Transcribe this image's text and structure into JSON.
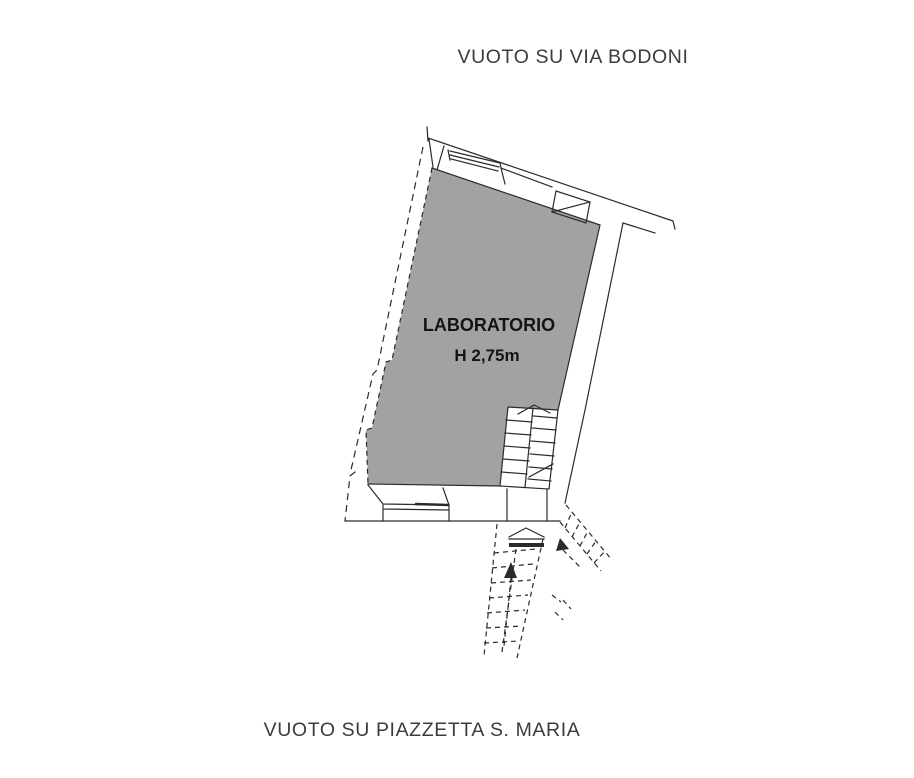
{
  "labels": {
    "top": "VUOTO SU VIA BODONI",
    "bottom": "VUOTO SU PIAZZETTA S. MARIA"
  },
  "room": {
    "name": "LABORATORIO",
    "height_note": "H 2,75m"
  },
  "colors": {
    "bg": "#ffffff",
    "line": "#2b2b2b",
    "room_fill": "#a2a2a2",
    "room_text": "#141414",
    "label_text": "#3c3c3c"
  }
}
